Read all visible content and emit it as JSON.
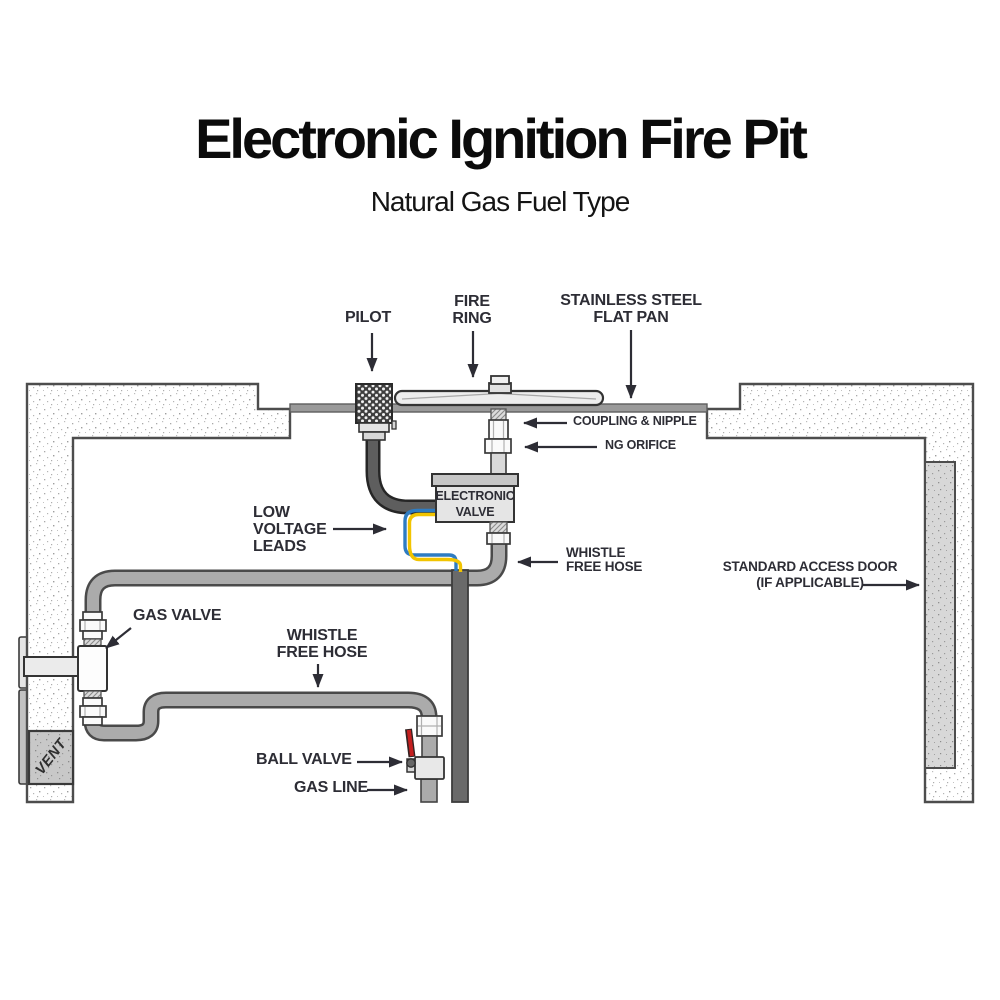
{
  "title": "Electronic Ignition Fire Pit",
  "subtitle": "Natural Gas Fuel Type",
  "labels": {
    "pilot": "PILOT",
    "fire_ring": "FIRE\nRING",
    "flat_pan": "STAINLESS STEEL\nFLAT PAN",
    "coupling_nipple": "COUPLING & NIPPLE",
    "ng_orifice": "NG ORIFICE",
    "electronic_valve": "ELECTRONIC\nVALVE",
    "low_voltage_leads": "LOW\nVOLTAGE\nLEADS",
    "whistle_free_hose_upper": "WHISTLE\nFREE HOSE",
    "standard_access_door": "STANDARD ACCESS DOOR\n(IF APPLICABLE)",
    "gas_valve": "GAS VALVE",
    "whistle_free_hose_lower": "WHISTLE\nFREE HOSE",
    "ball_valve": "BALL VALVE",
    "gas_line": "GAS LINE",
    "vent": "VENT"
  },
  "colors": {
    "label-color": "#2d2d35",
    "title-color": "#0b0b0b",
    "hose-fill": "#ababab",
    "hose-stroke": "#4a4a4a",
    "conduit-fill": "#6a6a6a",
    "pan-fill": "#9a9a9a",
    "wire-blue": "#2e7cc2",
    "wire-yellow": "#f2c400",
    "handle-red": "#c41f1f",
    "outline": "#3a3a3a",
    "wall-stroke": "#4d4d4d"
  }
}
